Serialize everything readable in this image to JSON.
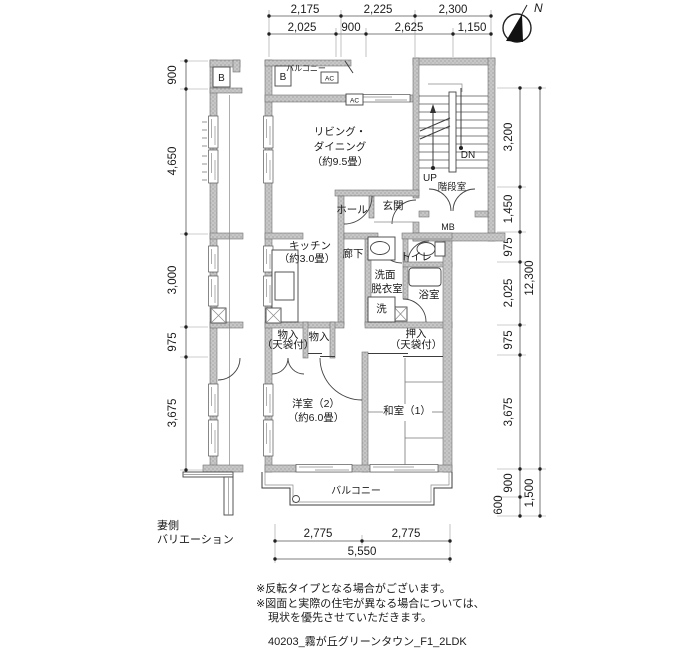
{
  "compass": {
    "north": "N"
  },
  "dims": {
    "top_row1": [
      "2,175",
      "2,225",
      "2,300"
    ],
    "top_row2": [
      "2,025",
      "900",
      "2,625",
      "1,150"
    ],
    "left": [
      "900",
      "4,650",
      "3,000",
      "975",
      "3,675"
    ],
    "right_inner": [
      "3,200",
      "1,450",
      "975",
      "2,025",
      "975",
      "3,675",
      "900",
      "600"
    ],
    "right_outer": [
      "12,300",
      "1,500"
    ],
    "bottom_inner": [
      "2,775",
      "2,775"
    ],
    "bottom_total": "5,550"
  },
  "rooms": {
    "living": {
      "line1": "リビング・",
      "line2": "ダイニング",
      "line3": "（約9.5畳）"
    },
    "kitchen": {
      "line1": "キッチン",
      "line2": "（約3.0畳）"
    },
    "hall": "ホール",
    "entrance": "玄関",
    "stair_room": "階段室",
    "corridor": "廊下",
    "washroom": {
      "line1": "洗面",
      "line2": "脱衣室"
    },
    "toilet": "トイレ",
    "bath": "浴室",
    "laundry": "洗",
    "storage1": {
      "line1": "物入",
      "line2": "（天袋付）"
    },
    "storage2": "物入",
    "oshiire": {
      "line1": "押入",
      "line2": "（天袋付）"
    },
    "western": {
      "line1": "洋室（2）",
      "line2": "（約6.0畳）"
    },
    "japanese": "和室（1）",
    "balcony_top": "バルコニー",
    "balcony_bottom": "バルコニー"
  },
  "marks": {
    "b": "B",
    "ac": "AC",
    "mb": "MB",
    "up": "UP",
    "dn": "DN"
  },
  "gable": {
    "line1": "妻側",
    "line2": "バリエーション"
  },
  "notes": {
    "note1": "※反転タイプとなる場合がございます。",
    "note2": "※図面と実際の住宅が異なる場合については、",
    "note3": "現状を優先させていただきます。",
    "plan_id": "40203_霧が丘グリーンタウン_F1_2LDK"
  },
  "colors": {
    "wall": "#c7c7c7",
    "line": "#333333"
  }
}
